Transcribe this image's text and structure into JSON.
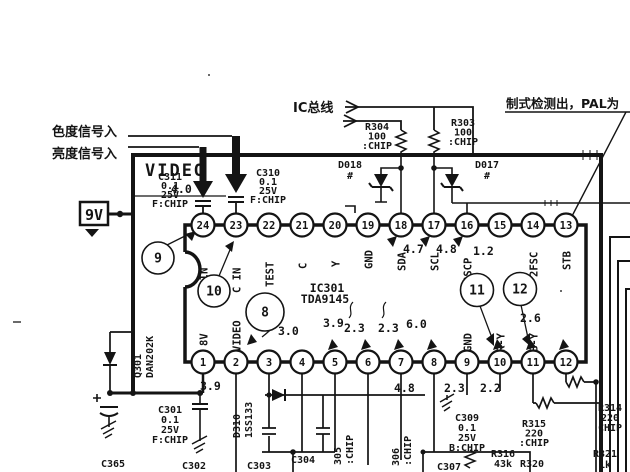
{
  "annotations": {
    "chroma_in": "色度信号入",
    "luma_in": "亮度信号入",
    "ic_bus": "IC总线",
    "pal_note": "制式检测出，PAL为",
    "video": "VIDEO",
    "supply": "9V"
  },
  "ic": {
    "ref": "IC301",
    "part": "TDA9145",
    "top_pins": [
      {
        "num": "24",
        "label": "Y IN"
      },
      {
        "num": "23",
        "label": "C IN"
      },
      {
        "num": "22",
        "label": "TEST"
      },
      {
        "num": "21",
        "label": "C"
      },
      {
        "num": "20",
        "label": "Y"
      },
      {
        "num": "19",
        "label": "GND"
      },
      {
        "num": "18",
        "label": "SDA"
      },
      {
        "num": "17",
        "label": "SCL"
      },
      {
        "num": "16",
        "label": "SSCP"
      },
      {
        "num": "15",
        "label": ""
      },
      {
        "num": "14",
        "label": "2FSC"
      },
      {
        "num": "13",
        "label": "STB"
      }
    ],
    "bottom_pins": [
      {
        "num": "1",
        "label": "8V"
      },
      {
        "num": "2",
        "label": "VIDEO"
      },
      {
        "num": "3",
        "label": ""
      },
      {
        "num": "4",
        "label": ""
      },
      {
        "num": "5",
        "label": ""
      },
      {
        "num": "6",
        "label": ""
      },
      {
        "num": "7",
        "label": ""
      },
      {
        "num": "8",
        "label": ""
      },
      {
        "num": "9",
        "label": "GND"
      },
      {
        "num": "10",
        "label": "R-Y"
      },
      {
        "num": "11",
        "label": "B-Y"
      },
      {
        "num": "12",
        "label": ""
      }
    ]
  },
  "voltages": [
    "4.0",
    "4.7",
    "4.8",
    "1.2",
    "3.0",
    "3.9",
    "2.3",
    "2.3",
    "6.0",
    "2.6",
    "3.9",
    "4.8",
    "2.3",
    "2.2"
  ],
  "callouts": [
    "9",
    "10",
    "8",
    "11",
    "12"
  ],
  "components": {
    "c311": {
      "lines": [
        "C311",
        "0.1",
        "25V",
        "F:CHIP"
      ]
    },
    "c310": {
      "lines": [
        "C310",
        "0.1",
        "25V",
        "F:CHIP"
      ]
    },
    "r304": {
      "lines": [
        "R304",
        "100",
        ":CHIP"
      ]
    },
    "r303": {
      "lines": [
        "R303",
        "100",
        ":CHIP"
      ]
    },
    "d018": {
      "lines": [
        "D018",
        "#"
      ]
    },
    "d017": {
      "lines": [
        "D017",
        "#"
      ]
    },
    "q301": {
      "lines": [
        "Q301",
        "DAN202K"
      ]
    },
    "d310": {
      "lines": [
        "D310",
        "1SS133"
      ]
    },
    "c301": {
      "lines": [
        "C301",
        "0.1",
        "25V",
        "F:CHIP"
      ]
    },
    "c365": {
      "lines": [
        "C365"
      ]
    },
    "c302": {
      "lines": [
        "C302"
      ]
    },
    "c303": {
      "lines": [
        "C303"
      ]
    },
    "c304": {
      "lines": [
        "C304"
      ]
    },
    "r305": {
      "lines": [
        "305",
        ":CHIP"
      ]
    },
    "r306": {
      "lines": [
        "306",
        ":CHIP"
      ]
    },
    "c307": {
      "lines": [
        "C307"
      ]
    },
    "c309": {
      "lines": [
        "C309",
        "0.1",
        "25V",
        "B:CHIP"
      ]
    },
    "r315": {
      "lines": [
        "R315",
        "220",
        ":CHIP"
      ]
    },
    "r316": {
      "lines": [
        "R316",
        "43k"
      ]
    },
    "r320": {
      "lines": [
        "R320"
      ]
    },
    "r314": {
      "lines": [
        "R314",
        "220",
        "CHIP"
      ]
    },
    "r321": {
      "lines": [
        "R321",
        "1k"
      ]
    }
  }
}
